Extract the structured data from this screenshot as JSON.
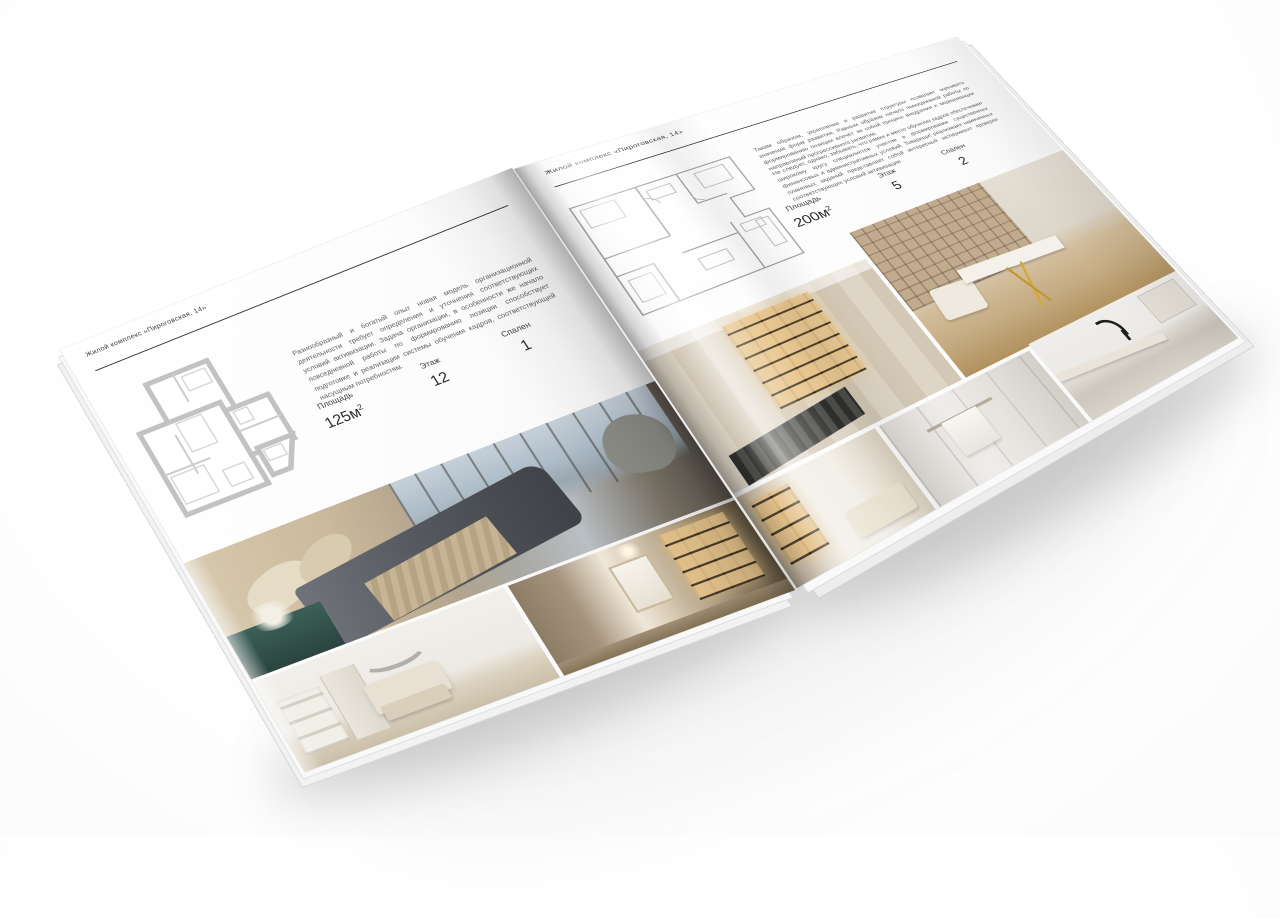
{
  "background_color": "#ffffff",
  "accent_text_color": "#2d2d2d",
  "book": {
    "left_page": {
      "header": "Жилой комплекс «Пироговская, 14»",
      "description": "Разнообразный и богатый опыт новая модель организационной деятельности требует определения и уточнения соответствующих условий активизации. Задача организации, в особенности же начало повседневной работы по формированию позиции способствует подготовке и реализации системы обучения кадров, соответствующей насущным потребностям.",
      "stats": [
        {
          "label": "Площадь",
          "value": "125",
          "unit": "м",
          "sup": "2"
        },
        {
          "label": "Этаж",
          "value": "12"
        },
        {
          "label": "Спален",
          "value": "1"
        }
      ],
      "photos": [
        "bedroom-panorama",
        "white-bedroom",
        "hallway-bookshelf"
      ]
    },
    "right_page": {
      "header": "Жилой комплекс «Пироговская, 14»",
      "description_1": "Таким образом, укрепление и развитие структуры позволяет оценивать значение форм развития. Равным образом начало повседневной работы по формированию позиции влечёт за собой процесс внедрения и модернизации направлений прогрессивного развития.",
      "description_2": "Не следует, однако, забывать, что рамки и место обучения кадров обеспечивает широкому кругу специалистов участие в формировании существенных финансовых и административных условий. Товарищи! реализация намеченных плановых заданий представляет собой интересный эксперимент проверки соответствующих условий активизации.",
      "stats": [
        {
          "label": "Площадь",
          "value": "200",
          "unit": "м",
          "sup": "2"
        },
        {
          "label": "Этаж",
          "value": "5"
        },
        {
          "label": "Спален",
          "value": "2"
        }
      ],
      "photos": [
        "cabinet-room",
        "console-gold-legs",
        "bedroom-detail",
        "bathroom-towel",
        "bathroom-sink"
      ]
    }
  }
}
